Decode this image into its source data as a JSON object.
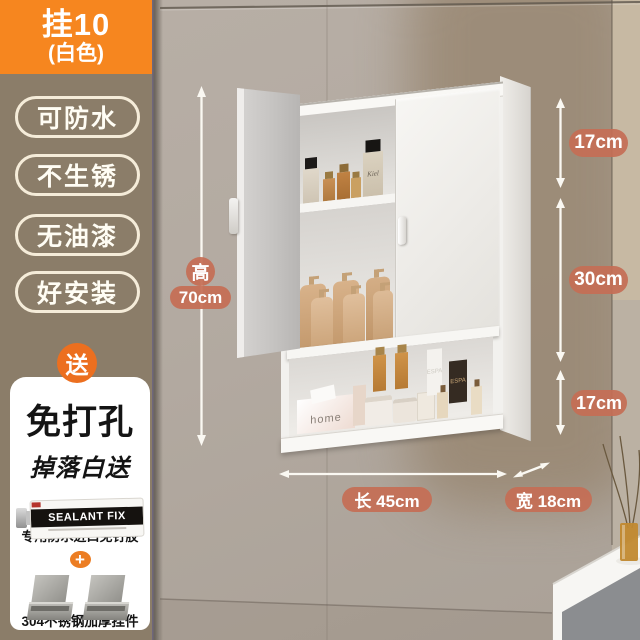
{
  "sidebar": {
    "badge": {
      "line1": "挂10",
      "line2": "(白色)"
    },
    "tags": [
      {
        "label": "可防水"
      },
      {
        "label": "不生锈"
      },
      {
        "label": "无油漆"
      },
      {
        "label": "好安装"
      }
    ],
    "gift": {
      "ribbon": "送",
      "title": "免打孔",
      "subtitle": "掉落白送",
      "glue_brand": "SEALANT FIX",
      "glue_caption": "专用防水进口免钉胶",
      "plus_sign": "+",
      "bracket_caption": "304不锈钢加厚挂件"
    }
  },
  "annotations": {
    "height_char": "高",
    "height_value": "70cm",
    "seg_top": "17cm",
    "seg_mid": "30cm",
    "seg_bottom": "17cm",
    "length": "长 45cm",
    "depth": "宽 18cm"
  },
  "cabinet_items": {
    "tissue_brand": "home",
    "dark_bottle_label": "ESPA",
    "spray_bottle_label": "ESPA",
    "perfume_label": "Kiel"
  },
  "colors": {
    "accent_orange": "#f6861f",
    "gift_orange": "#ec6f1f",
    "tag_panel_brown": "#8b7d69",
    "dim_badge_salmon": "#c56e55",
    "wall_grey": "#b3aaa1",
    "wall_shadow_brown": "#97856f",
    "cabinet_white": "#f2f1ee"
  }
}
